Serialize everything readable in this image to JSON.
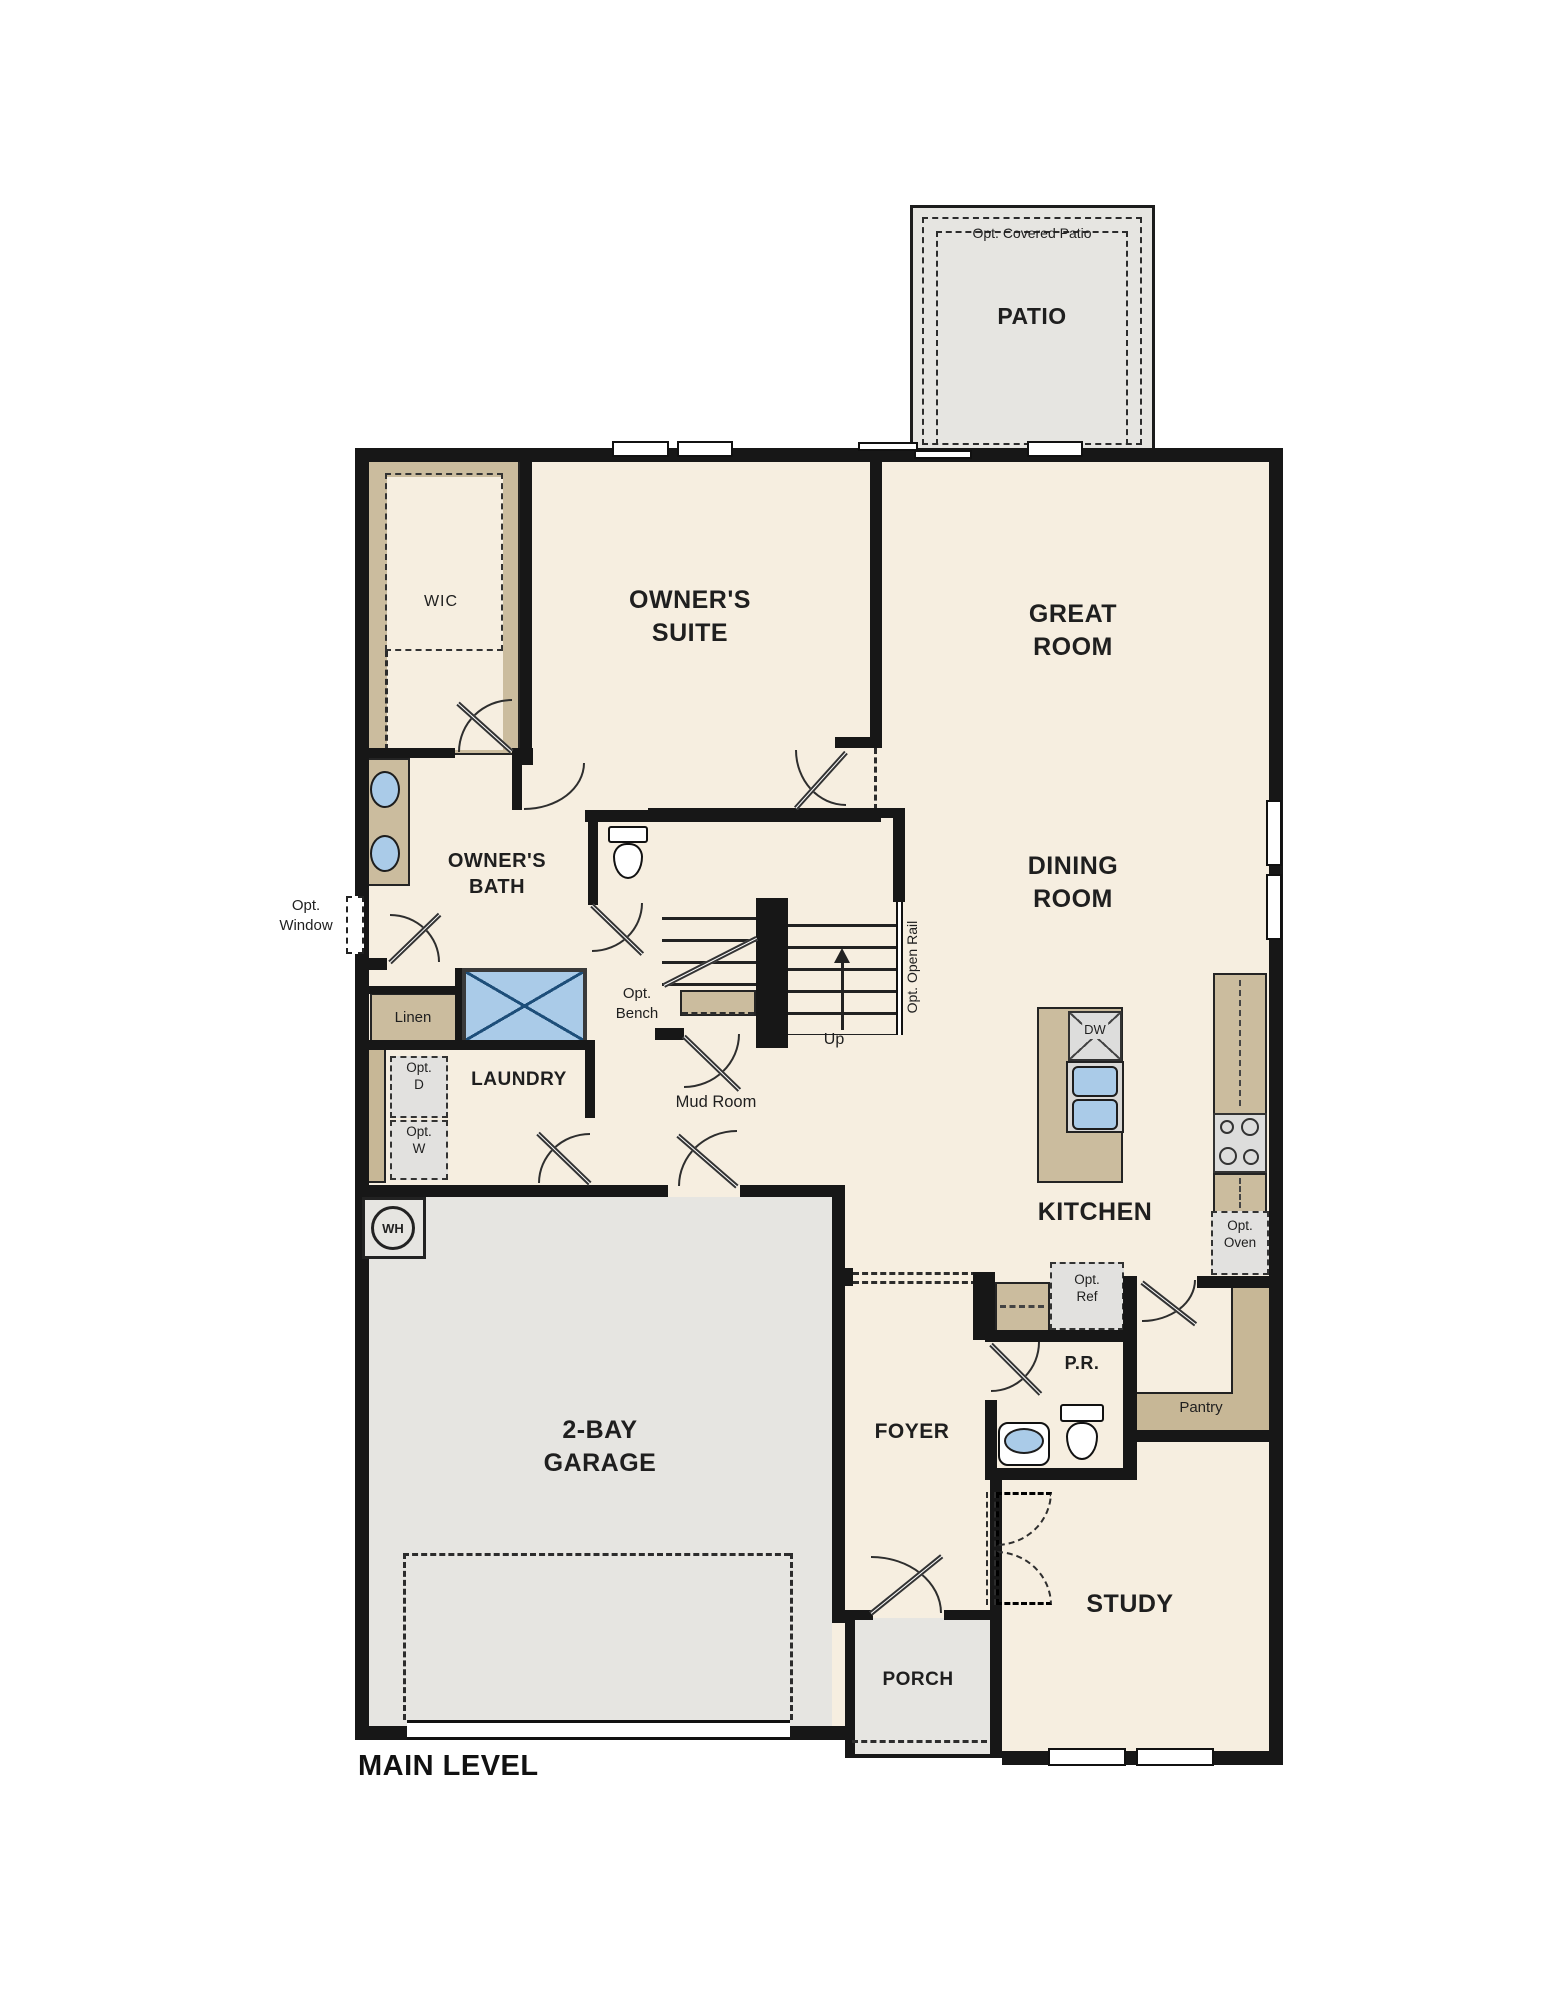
{
  "plan": {
    "title": "MAIN LEVEL",
    "colors": {
      "wall": "#171717",
      "interior": "#f6eee0",
      "concrete": "#e6e5e1",
      "casework": "#cbbc9e",
      "fixture_blue": "#aacbe8"
    },
    "labels": {
      "patio_note": "Opt. Covered Patio",
      "patio": "PATIO",
      "suite1": "OWNER'S",
      "suite2": "SUITE",
      "wic": "WIC",
      "great1": "GREAT",
      "great2": "ROOM",
      "dining1": "DINING",
      "dining2": "ROOM",
      "bath1": "OWNER'S",
      "bath2": "BATH",
      "optwin1": "Opt.",
      "optwin2": "Window",
      "linen": "Linen",
      "optbench1": "Opt.",
      "optbench2": "Bench",
      "laundry": "LAUNDRY",
      "optd1": "Opt.",
      "optd2": "D",
      "optw1": "Opt.",
      "optw2": "W",
      "mud": "Mud Room",
      "up": "Up",
      "rail": "Opt. Open Rail",
      "kitchen": "KITCHEN",
      "dw": "DW",
      "optoven1": "Opt.",
      "optoven2": "Oven",
      "optref1": "Opt.",
      "optref2": "Ref",
      "pantry": "Pantry",
      "pr": "P.R.",
      "foyer": "FOYER",
      "garage1": "2-BAY",
      "garage2": "GARAGE",
      "wh": "WH",
      "porch": "PORCH",
      "study": "STUDY",
      "main_level": "MAIN LEVEL"
    }
  }
}
